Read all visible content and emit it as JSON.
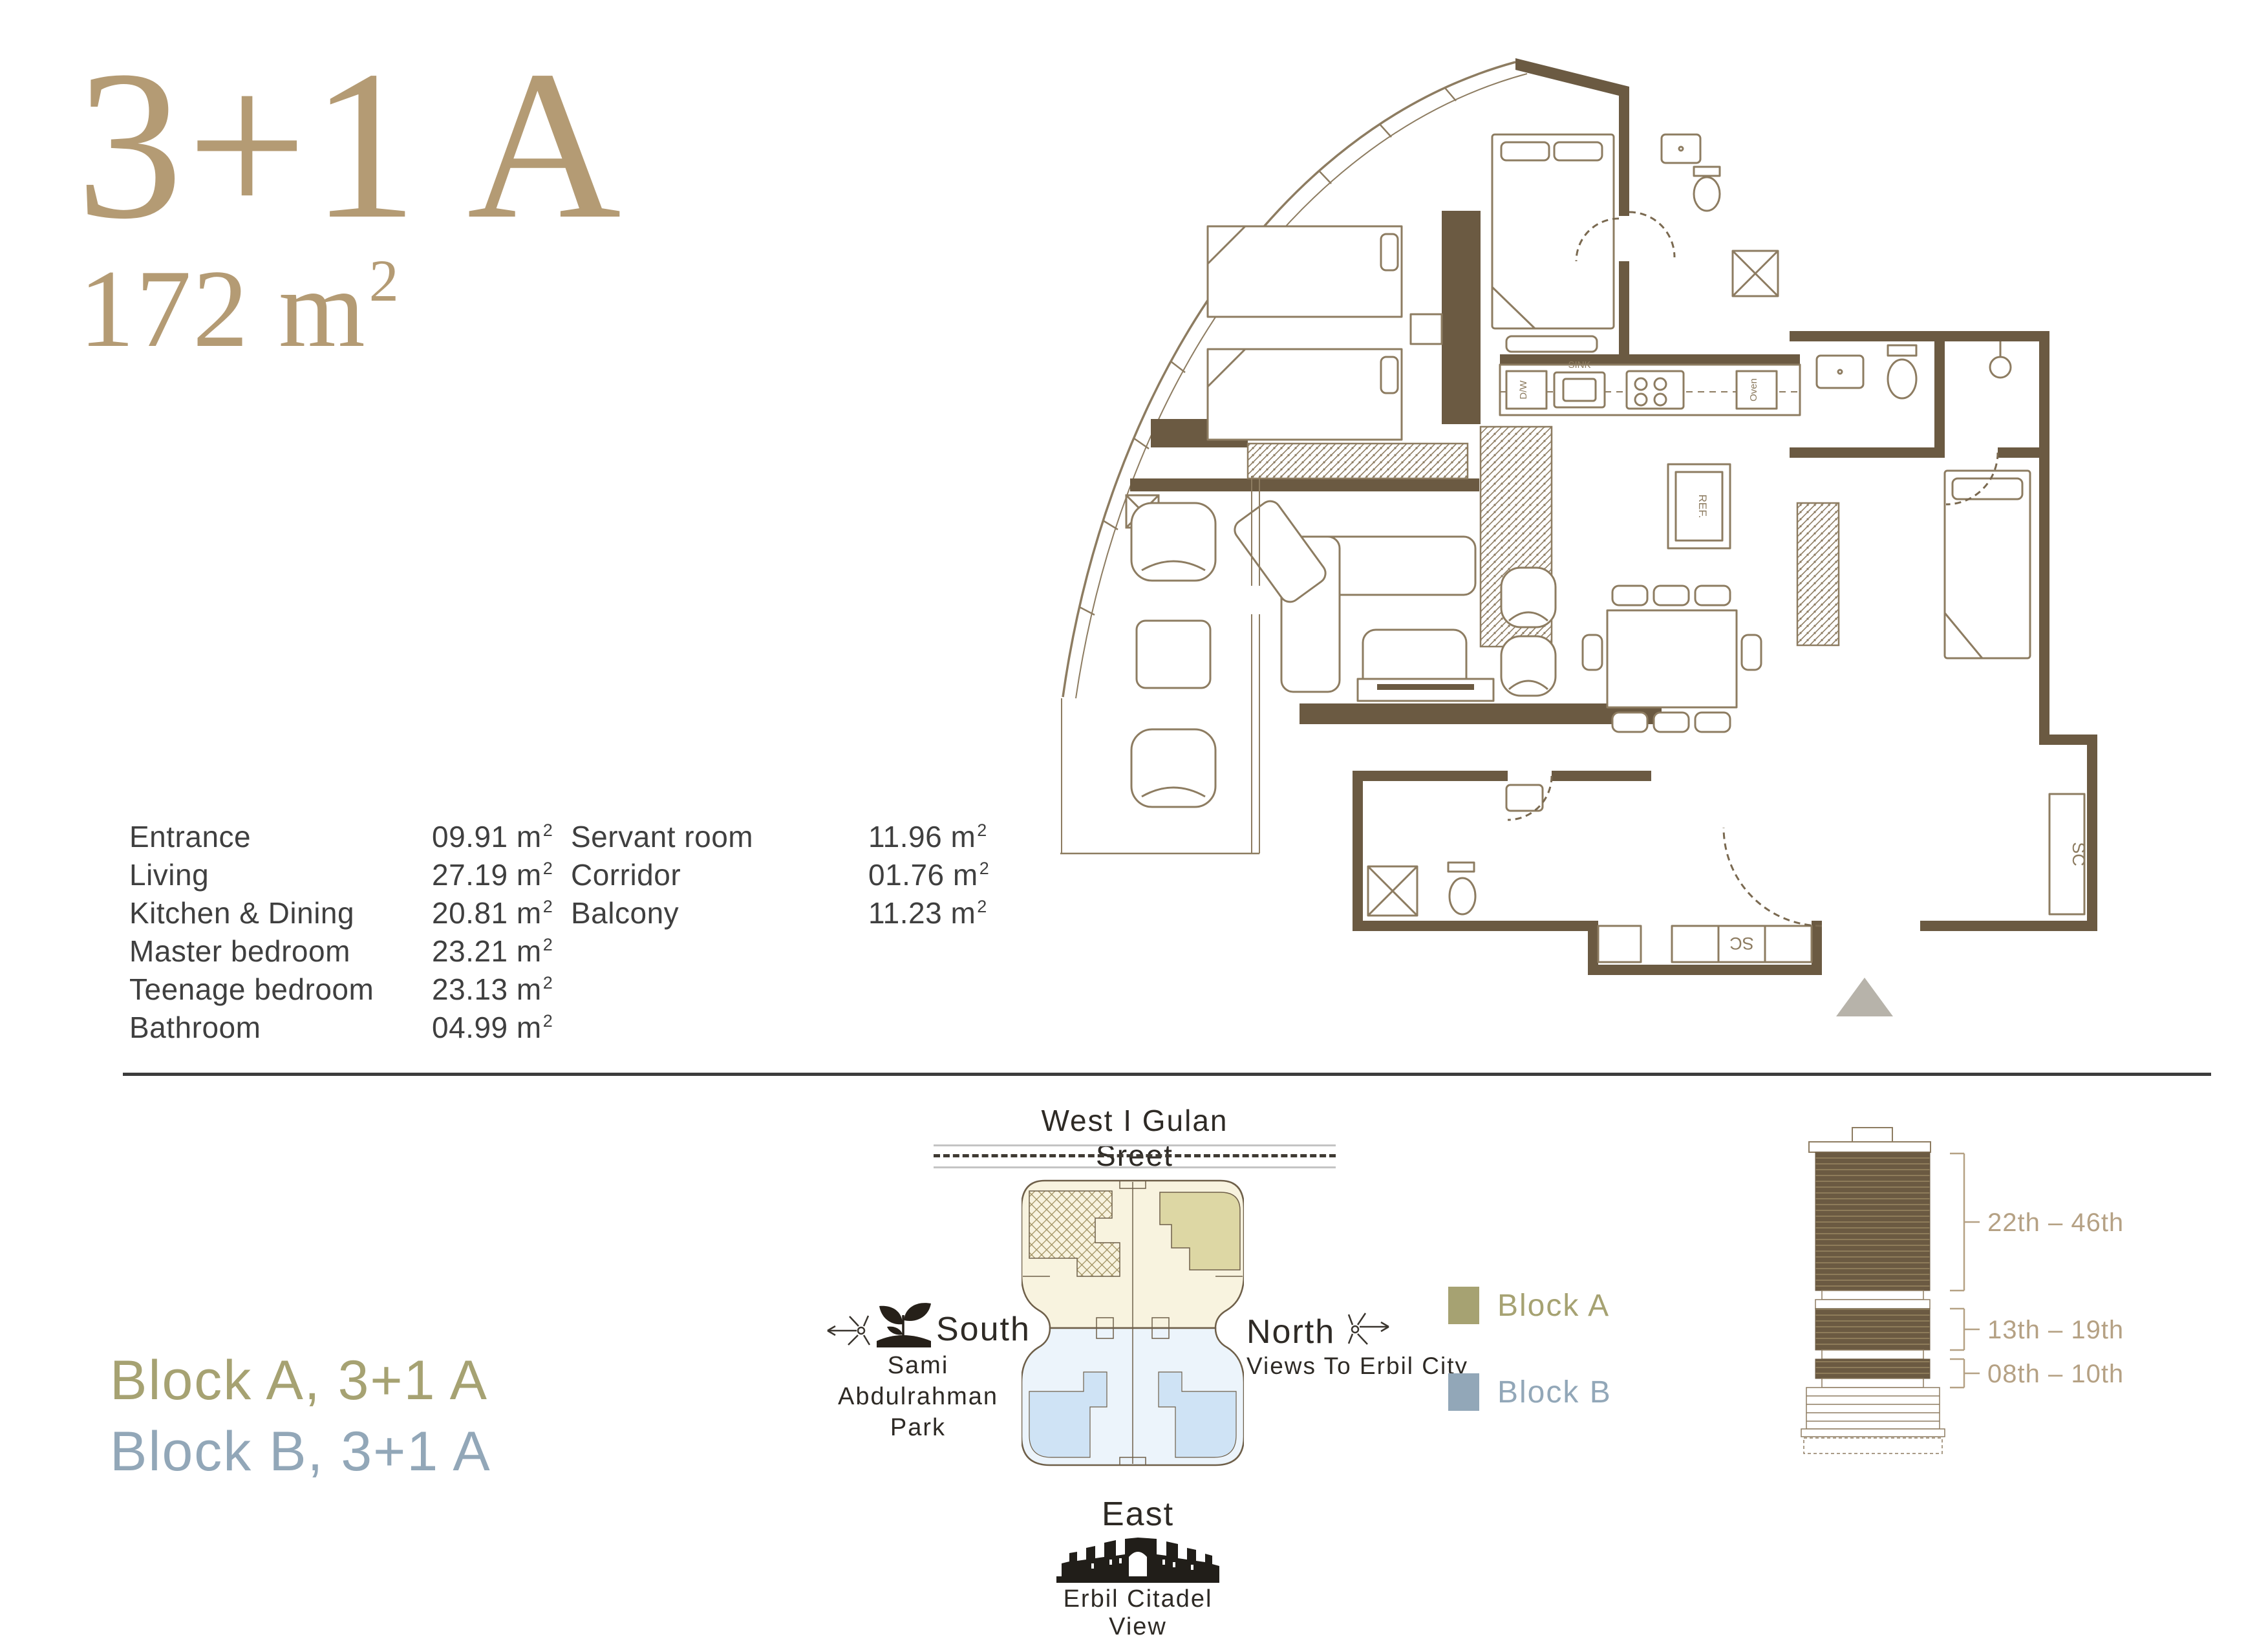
{
  "colors": {
    "accent_tan": "#b49b74",
    "wall_brown": "#6b5a42",
    "furniture_line": "#8d7c61",
    "block_a": "#a6a272",
    "block_a_fill": "#ddd7a4",
    "block_b": "#92a7b8",
    "block_b_fill": "#cfe3f5",
    "site_cream": "#f8f3df",
    "site_blue": "#ecf4fb",
    "elevation_label": "#b5a184",
    "text_dark": "#3f3f3f"
  },
  "header": {
    "unit_type": "3+1 A",
    "area_value": "172 m",
    "area_exponent": "2"
  },
  "rooms": {
    "left": [
      {
        "label": "Entrance",
        "value": "09.91 m",
        "exp": "2"
      },
      {
        "label": "Living",
        "value": "27.19 m",
        "exp": "2"
      },
      {
        "label": "Kitchen & Dining",
        "value": "20.81 m",
        "exp": "2"
      },
      {
        "label": "Master bedroom",
        "value": "23.21 m",
        "exp": "2"
      },
      {
        "label": "Teenage bedroom",
        "value": "23.13 m",
        "exp": "2"
      },
      {
        "label": "Bathroom",
        "value": "04.99 m",
        "exp": "2"
      }
    ],
    "right": [
      {
        "label": "Servant room",
        "value": "11.96 m",
        "exp": "2"
      },
      {
        "label": "Corridor",
        "value": "01.76 m",
        "exp": "2"
      },
      {
        "label": "Balcony",
        "value": "11.23 m",
        "exp": "2"
      }
    ]
  },
  "site": {
    "street": "West I Gulan Sreet",
    "south": {
      "title": "South",
      "line1": "Sami Abdulrahman",
      "line2": "Park"
    },
    "north": {
      "title": "North",
      "subtitle": "Views To Erbil City"
    },
    "east": {
      "title": "East",
      "subtitle": "Erbil Citadel View"
    },
    "legend": [
      {
        "label": "Block A"
      },
      {
        "label": "Block B"
      }
    ]
  },
  "blocks": [
    {
      "title": "Block A, 3+1 A"
    },
    {
      "title": "Block B, 3+1 A"
    }
  ],
  "elevation": {
    "ranges": [
      "22th – 46th",
      "13th – 19th",
      "08th – 10th"
    ]
  },
  "plan": {
    "sc_entry": "SC",
    "sc_side": "SC",
    "ref": "REF.",
    "sink": "SINK",
    "oven": "Oven",
    "dw": "D/W"
  }
}
